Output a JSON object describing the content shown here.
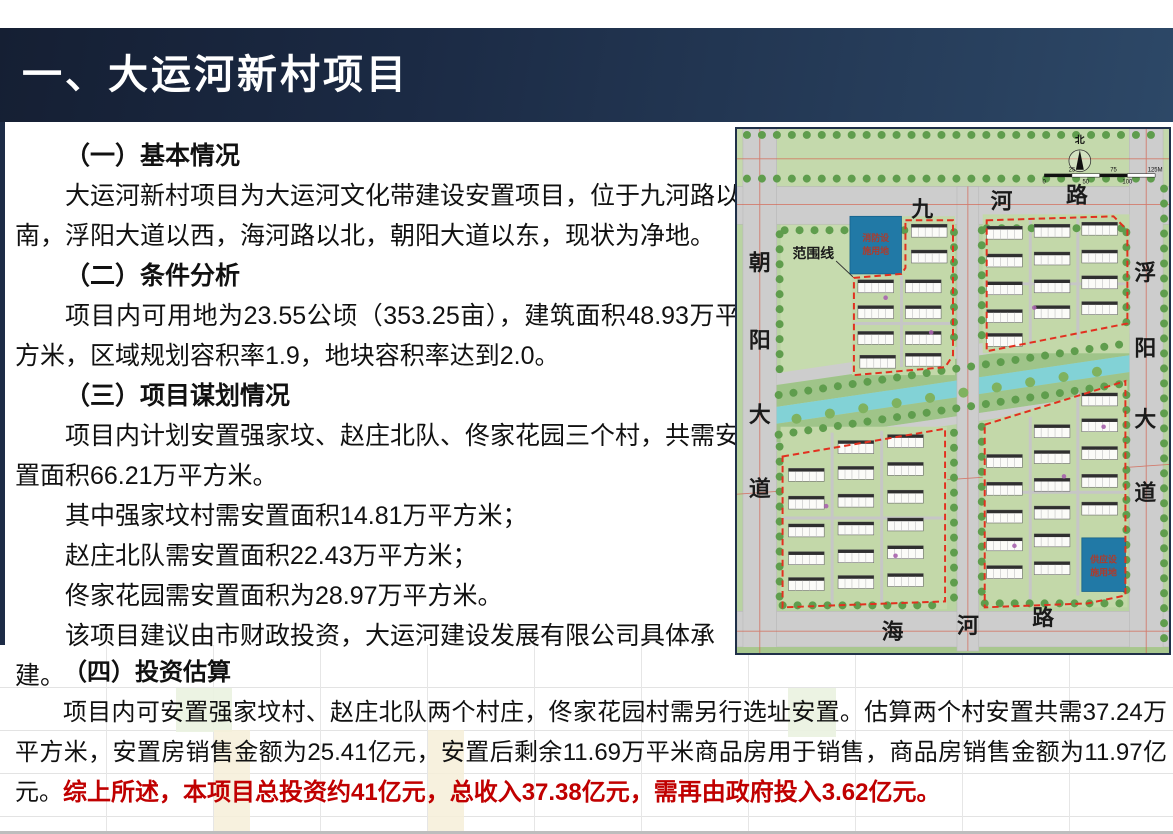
{
  "slide_title": "一、大运河新村项目",
  "sections": {
    "s1": {
      "heading": "（一）基本情况",
      "body": "大运河新村项目为大运河文化带建设安置项目，位于九河路以南，浮阳大道以西，海河路以北，朝阳大道以东，现状为净地。"
    },
    "s2": {
      "heading": "（二）条件分析",
      "body": "项目内可用地为23.55公顷（353.25亩），建筑面积48.93万平方米，区域规划容积率1.9，地块容积率达到2.0。"
    },
    "s3": {
      "heading": "（三）项目谋划情况",
      "body": "项目内计划安置强家坟、赵庄北队、佟家花园三个村，共需安置面积66.21万平方米。",
      "lines": [
        "其中强家坟村需安置面积14.81万平方米；",
        "赵庄北队需安置面积22.43万平方米；",
        "佟家花园需安置面积为28.97万平方米。",
        "该项目建议由市财政投资，大运河建设发展有限公司具体承建。"
      ]
    },
    "s4": {
      "heading": "（四）投资估算",
      "body": "项目内可安置强家坟村、赵庄北队两个村庄，佟家花园村需另行选址安置。估算两个村安置共需37.24万平方米，安置房销售金额为25.41亿元，安置后剩余11.69万平米商品房用于销售，商品房销售金额为11.97亿元。",
      "highlight": "综上所述，本项目总投资约41亿元，总收入37.38亿元，需再由政府投入3.62亿元。"
    }
  },
  "map": {
    "roads": {
      "north": "九河路",
      "west": "朝阳大道",
      "east": "浮阳大道",
      "south": "海河路"
    },
    "north_chars": [
      "九",
      "河",
      "路"
    ],
    "west_chars": [
      "朝",
      "阳",
      "大",
      "道"
    ],
    "east_chars": [
      "浮",
      "阳",
      "大",
      "道"
    ],
    "south_chars": [
      "海",
      "河",
      "路"
    ],
    "boundary_label": "范围线",
    "fire_plot": {
      "name": "消防设施用地",
      "l1": "消防设",
      "l2": "施用地"
    },
    "supply_plot": {
      "name": "供应设施用地",
      "l1": "供应设",
      "l2": "施用地"
    },
    "compass_north": "北",
    "scale_top": [
      "25",
      "75",
      "125M"
    ],
    "scale_bottom": [
      "0",
      "50",
      "100"
    ]
  },
  "colors": {
    "header_dark": "#151f33",
    "header_light": "#2d4867",
    "accent_red": "#c00000",
    "boundary_red": "#e2301f",
    "water": "#82d2d6"
  }
}
